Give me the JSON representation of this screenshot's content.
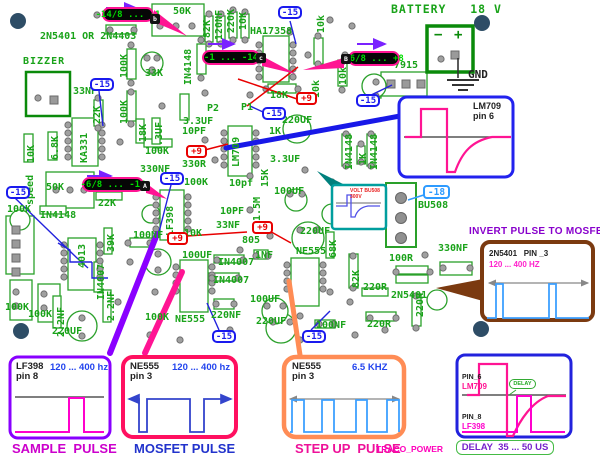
{
  "top": {
    "battery": "BATTERY   18 V",
    "gnd": "GND",
    "minus": "−",
    "plus": "+"
  },
  "badges": {
    "b1": "-14/8 ... -1",
    "b1_pin": "b",
    "b2": "-1 ... -14",
    "b2_pin": "c",
    "b3": "+6/8 ... +8",
    "b3_pin": "B",
    "b4": "-6/8 ... -14",
    "b4_pin": "A",
    "neg15": "-15",
    "pos9": "+9",
    "neg18": "-18"
  },
  "silkscreen": [
    "50K",
    "2N5401 OR 2N4403",
    "BIZZER",
    "33NF",
    "100K",
    "100K",
    "33K",
    "IN4148",
    "22K",
    "82K",
    "120NF",
    "220K",
    "10K",
    "HA17358",
    "10k",
    "10k",
    "10k",
    "18K",
    "P2",
    "P1",
    "7915",
    "10K",
    "6.8K",
    "KA331",
    "18K",
    "3.3UF",
    "3.3UF",
    "100K",
    "330NF",
    "speed",
    "50K",
    "22K",
    "100K",
    "IN4148",
    "4013",
    "39K",
    "IN4007",
    "2.2NF",
    "100K",
    "100K",
    "220UF",
    "2.2NF",
    "100K",
    "NE555",
    "220NF",
    "LF398",
    "100K",
    "10pf",
    "10PF",
    "33NF",
    "100NF",
    "10K",
    "805",
    "100UF",
    "IN4007",
    "IN4007",
    "1NF",
    "220UF",
    "NE555",
    "68K",
    "100UF",
    "220UF",
    "100NF",
    "LM709",
    "220UF",
    "1K",
    "3.3UF",
    "100UF",
    "15K",
    "1.5M",
    "330R",
    "10PF",
    "IN4148",
    "1K",
    "IN4148",
    "BU508",
    "330NF",
    "100R",
    "82K",
    "220R",
    "2N5401",
    "220R",
    "220R"
  ],
  "insets": {
    "lm709": {
      "chip": "LM709",
      "pin": "pin 6"
    },
    "volt": {
      "line1": "VOLT BU508",
      "line2": "300V"
    },
    "invert": {
      "heading": "INVERT PULSE TO MOSFET",
      "chip": "2N5401   PIN _3",
      "freq": "120 ... 400 HZ"
    },
    "sample": {
      "chip": "LF398",
      "pin": "pin 8",
      "freq": "120 ... 400 hz",
      "caption": "SAMPLE  PULSE"
    },
    "mosfet": {
      "chip": "NE555",
      "pin": "pin 3",
      "freq": "120 ... 400 hz",
      "caption": "MOSFET PULSE"
    },
    "stepup": {
      "chip": "NE555",
      "pin": "pin 3",
      "freq": "6.5 KHZ",
      "caption": "STEP UP  PULSE",
      "brand": "TRACO_POWER"
    },
    "delay": {
      "pin_top": "PIN_6",
      "chip_top": "LM709",
      "pin_bottom": "PIN_8",
      "chip_bottom": "LF398",
      "tag": "DELAY",
      "caption": "DELAY  35 ... 50 US"
    }
  },
  "colors": {
    "silkscreen": "#19a319",
    "badge_rail_text": "#00dd00",
    "badge_negative": "#1a1aee",
    "badge_positive": "#e80000",
    "badge_neg18": "#2e9bff",
    "callout_pink": "#ff1493",
    "callout_purple": "#8a00ff",
    "callout_blue": "#1818e8",
    "callout_orange": "#ff8c55",
    "callout_brown": "#7b3a10",
    "box_sample": "#8800ff",
    "box_mosfet": "#ff1060",
    "box_stepup": "#ff8c55",
    "box_delay": "#2222dd",
    "box_lm709": "#2222ee",
    "box_volt": "#009e9e",
    "heading_purple": "#8800cc"
  }
}
